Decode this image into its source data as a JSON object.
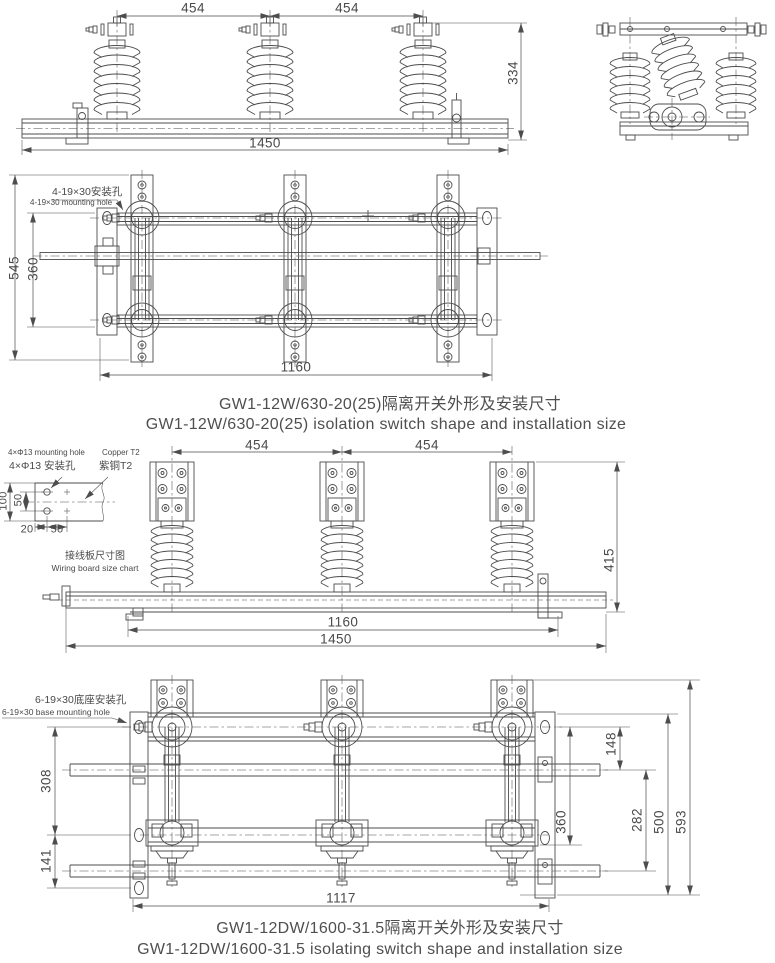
{
  "colors": {
    "line": "#4d4d4d",
    "text": "#4a4a4a",
    "background": "#ffffff"
  },
  "views": {
    "front_630": {
      "dim_pole_left": "454",
      "dim_pole_right": "454",
      "dim_height": "334",
      "dim_width": "1450"
    },
    "plan_630": {
      "hole_note_cn": "4-19×30安装孔",
      "hole_note_en": "4-19×30 mounting hole",
      "dim_depth": "545",
      "dim_rail_span": "360",
      "dim_mount_width": "1160"
    },
    "terminal_board": {
      "note_en_hole": "4×Φ13 mounting hole",
      "note_en_material": "Copper T2",
      "note_cn_hole": "4×Φ13 安装孔",
      "note_cn_material": "紫铜T2",
      "dim_height": "100",
      "dim_hole_v": "50",
      "dim_edge": "20",
      "dim_hole_h": "50",
      "caption_cn": "接线板尺寸图",
      "caption_en": "Wiring board size chart"
    },
    "front_1600": {
      "dim_pole_left": "454",
      "dim_pole_right": "454",
      "dim_height": "415",
      "dim_mount_width": "1160",
      "dim_width": "1450"
    },
    "plan_1600": {
      "hole_note_cn": "6-19×30底座安装孔",
      "hole_note_en": "6-19×30 base mounting hole",
      "dim_upper": "308",
      "dim_lower": "141",
      "dim_rod_gap": "148",
      "dim_bearing_span": "360",
      "dim_rod_span": "282",
      "dim_frame": "500",
      "dim_depth": "593",
      "dim_width": "1117"
    }
  },
  "captions": {
    "model_630_cn": "GW1-12W/630-20(25)隔离开关外形及安装尺寸",
    "model_630_en": "GW1-12W/630-20(25) isolation switch shape and installation size",
    "model_1600_cn": "GW1-12DW/1600-31.5隔离开关外形及安装尺寸",
    "model_1600_en": "GW1-12DW/1600-31.5 isolating switch shape and installation size"
  }
}
